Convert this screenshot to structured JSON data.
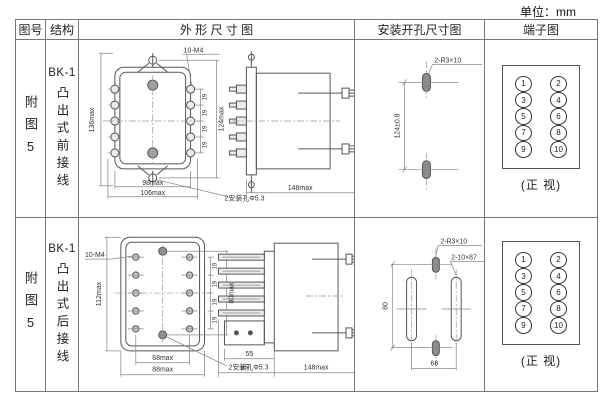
{
  "unit_label": "单位：mm",
  "table": {
    "headers": [
      "图号",
      "结构",
      "外 形 尺 寸 图",
      "安装开孔尺寸图",
      "端子图"
    ],
    "rows": [
      {
        "fig_no": "附图5",
        "model": "BK-1",
        "structure": "凸出式前接线",
        "outline": {
          "height_outer": "136max",
          "thread": "10-M4",
          "pitch": "19",
          "height_inner": "124max",
          "width_inner": "98max",
          "width_outer": "106max",
          "mount_note": "2安装孔Φ5.3",
          "side_depth": "148max"
        },
        "install": {
          "note": "2-R3×10",
          "pitch": "124±0.8"
        },
        "terminal": {
          "caption": "(正 视)",
          "left": [
            "1",
            "3",
            "5",
            "7",
            "9"
          ],
          "right": [
            "2",
            "4",
            "6",
            "8",
            "10"
          ]
        }
      },
      {
        "fig_no": "附图5",
        "model": "BK-1",
        "structure": "凸出式后接线",
        "outline": {
          "height_outer": "112max",
          "thread": "10-M4",
          "pitch": "19",
          "height_inner": "80max",
          "width_inner": "68max",
          "width_outer": "88max",
          "mount_note": "2安装孔Φ5.3",
          "side_pin": "55",
          "side_front": "65",
          "side_depth": "148max"
        },
        "install": {
          "note": "2-R3×10",
          "slot": "2-10×87",
          "height": "80",
          "width": "68"
        },
        "terminal": {
          "caption": "(正 视)",
          "left": [
            "1",
            "3",
            "5",
            "7",
            "9"
          ],
          "right": [
            "2",
            "4",
            "6",
            "8",
            "10"
          ]
        }
      }
    ]
  }
}
